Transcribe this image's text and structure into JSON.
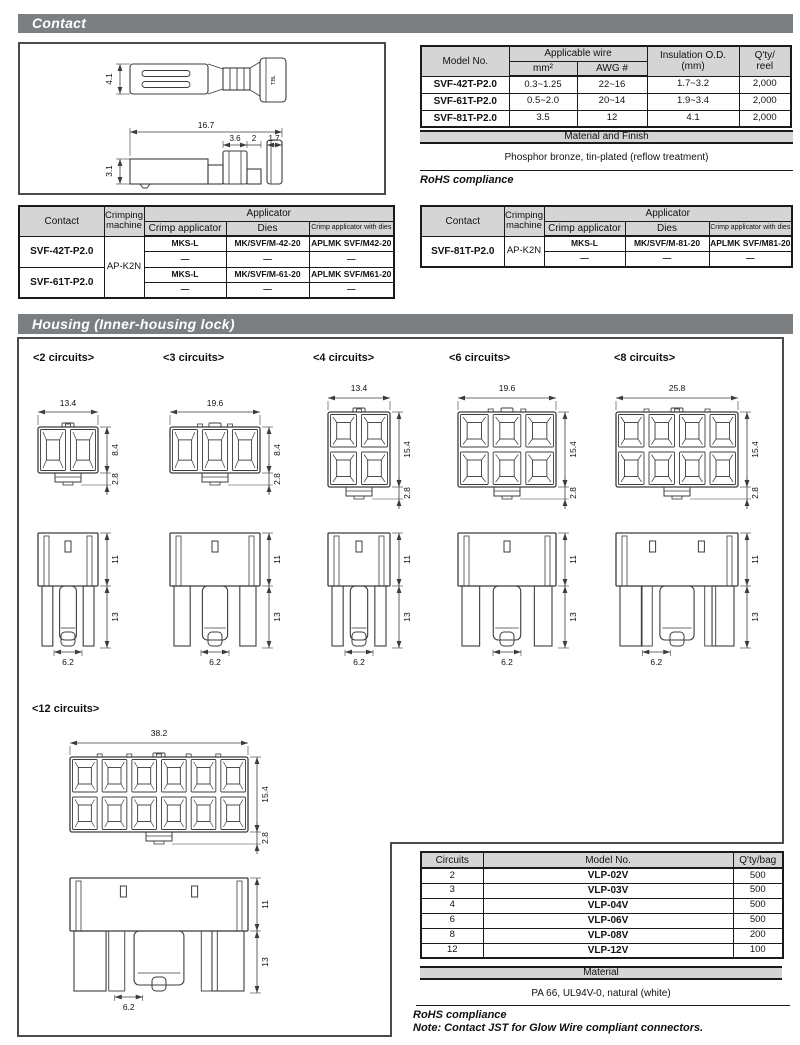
{
  "colors": {
    "section_bar_bg": "#7c7f82",
    "section_bar_text": "#ffffff",
    "table_header_bg": "#d5d5d5",
    "border": "#1a1a1a",
    "drawing_line": "#3c3c3c"
  },
  "contact_section": {
    "title": "Contact",
    "drawing_dims": {
      "plate_height": "4.1",
      "total_length": "16.7",
      "seg1": "3.6",
      "seg2": "2",
      "seg3": "1.7",
      "side_height": "3.1",
      "barrel_mark": "TBL"
    },
    "spec_table": {
      "col_model": "Model No.",
      "col_wire": "Applicable wire",
      "col_mm2": "mm²",
      "col_awg": "AWG #",
      "col_insulation": "Insulation O.D.\n(mm)",
      "col_qty": "Q'ty/\nreel",
      "rows": [
        {
          "model": "SVF-42T-P2.0",
          "mm2": "0.3~1.25",
          "awg": "22~16",
          "ins": "1.7~3.2",
          "qty": "2,000"
        },
        {
          "model": "SVF-61T-P2.0",
          "mm2": "0.5~2.0",
          "awg": "20~14",
          "ins": "1.9~3.4",
          "qty": "2,000"
        },
        {
          "model": "SVF-81T-P2.0",
          "mm2": "3.5",
          "awg": "12",
          "ins": "4.1",
          "qty": "2,000"
        }
      ]
    },
    "material_title": "Material and Finish",
    "material_text": "Phosphor bronze, tin-plated (reflow treatment)",
    "rohs": "RoHS compliance",
    "applicator_header": {
      "contact": "Contact",
      "machine": "Crimping\nmachine",
      "applicator": "Applicator",
      "crimp": "Crimp applicator",
      "dies": "Dies",
      "with_dies": "Crimp applicator with dies"
    },
    "applicator_tables": [
      {
        "machine": "AP-K2N",
        "groups": [
          {
            "contact": "SVF-42T-P2.0",
            "rows": [
              [
                "MKS-L",
                "MK/SVF/M-42-20",
                "APLMK SVF/M42-20"
              ],
              [
                "—",
                "—",
                "—"
              ]
            ]
          },
          {
            "contact": "SVF-61T-P2.0",
            "rows": [
              [
                "MKS-L",
                "MK/SVF/M-61-20",
                "APLMK SVF/M61-20"
              ],
              [
                "—",
                "—",
                "—"
              ]
            ]
          }
        ]
      },
      {
        "machine": "AP-K2N",
        "groups": [
          {
            "contact": "SVF-81T-P2.0",
            "rows": [
              [
                "MKS-L",
                "MK/SVF/M-81-20",
                "APLMK SVF/M81-20"
              ],
              [
                "—",
                "—",
                "—"
              ]
            ]
          }
        ]
      }
    ]
  },
  "housing_section": {
    "title": "Housing (Inner-housing lock)",
    "drawings": [
      {
        "label": "<2 circuits>",
        "circuits": 2,
        "cols": 2,
        "rows": 1,
        "width_dim": "13.4",
        "height_dim": "8.4",
        "latch_dim": "2.8",
        "upper_dim": "11",
        "lower_dim": "13",
        "foot_dim": "6.2"
      },
      {
        "label": "<3 circuits>",
        "circuits": 3,
        "cols": 3,
        "rows": 1,
        "width_dim": "19.6",
        "height_dim": "8.4",
        "latch_dim": "2.8",
        "upper_dim": "11",
        "lower_dim": "13",
        "foot_dim": "6.2"
      },
      {
        "label": "<4 circuits>",
        "circuits": 4,
        "cols": 2,
        "rows": 2,
        "width_dim": "13.4",
        "height_dim": "15.4",
        "latch_dim": "2.8",
        "upper_dim": "11",
        "lower_dim": "13",
        "foot_dim": "6.2"
      },
      {
        "label": "<6 circuits>",
        "circuits": 6,
        "cols": 3,
        "rows": 2,
        "width_dim": "19.6",
        "height_dim": "15.4",
        "latch_dim": "2.8",
        "upper_dim": "11",
        "lower_dim": "13",
        "foot_dim": "6.2"
      },
      {
        "label": "<8 circuits>",
        "circuits": 8,
        "cols": 4,
        "rows": 2,
        "width_dim": "25.8",
        "height_dim": "15.4",
        "latch_dim": "2.8",
        "upper_dim": "11",
        "lower_dim": "13",
        "foot_dim": "6.2"
      },
      {
        "label": "<12 circuits>",
        "circuits": 12,
        "cols": 6,
        "rows": 2,
        "width_dim": "38.2",
        "height_dim": "15.4",
        "latch_dim": "2.8",
        "upper_dim": "11",
        "lower_dim": "13",
        "foot_dim": "6.2"
      }
    ],
    "parts_table": {
      "col_circuits": "Circuits",
      "col_model": "Model No.",
      "col_qty": "Q'ty/bag",
      "rows": [
        [
          "2",
          "VLP-02V",
          "500"
        ],
        [
          "3",
          "VLP-03V",
          "500"
        ],
        [
          "4",
          "VLP-04V",
          "500"
        ],
        [
          "6",
          "VLP-06V",
          "500"
        ],
        [
          "8",
          "VLP-08V",
          "200"
        ],
        [
          "12",
          "VLP-12V",
          "100"
        ]
      ]
    },
    "material_title": "Material",
    "material_text": "PA 66, UL94V-0, natural (white)",
    "rohs": "RoHS compliance",
    "note": "Note: Contact JST for Glow Wire compliant connectors."
  }
}
